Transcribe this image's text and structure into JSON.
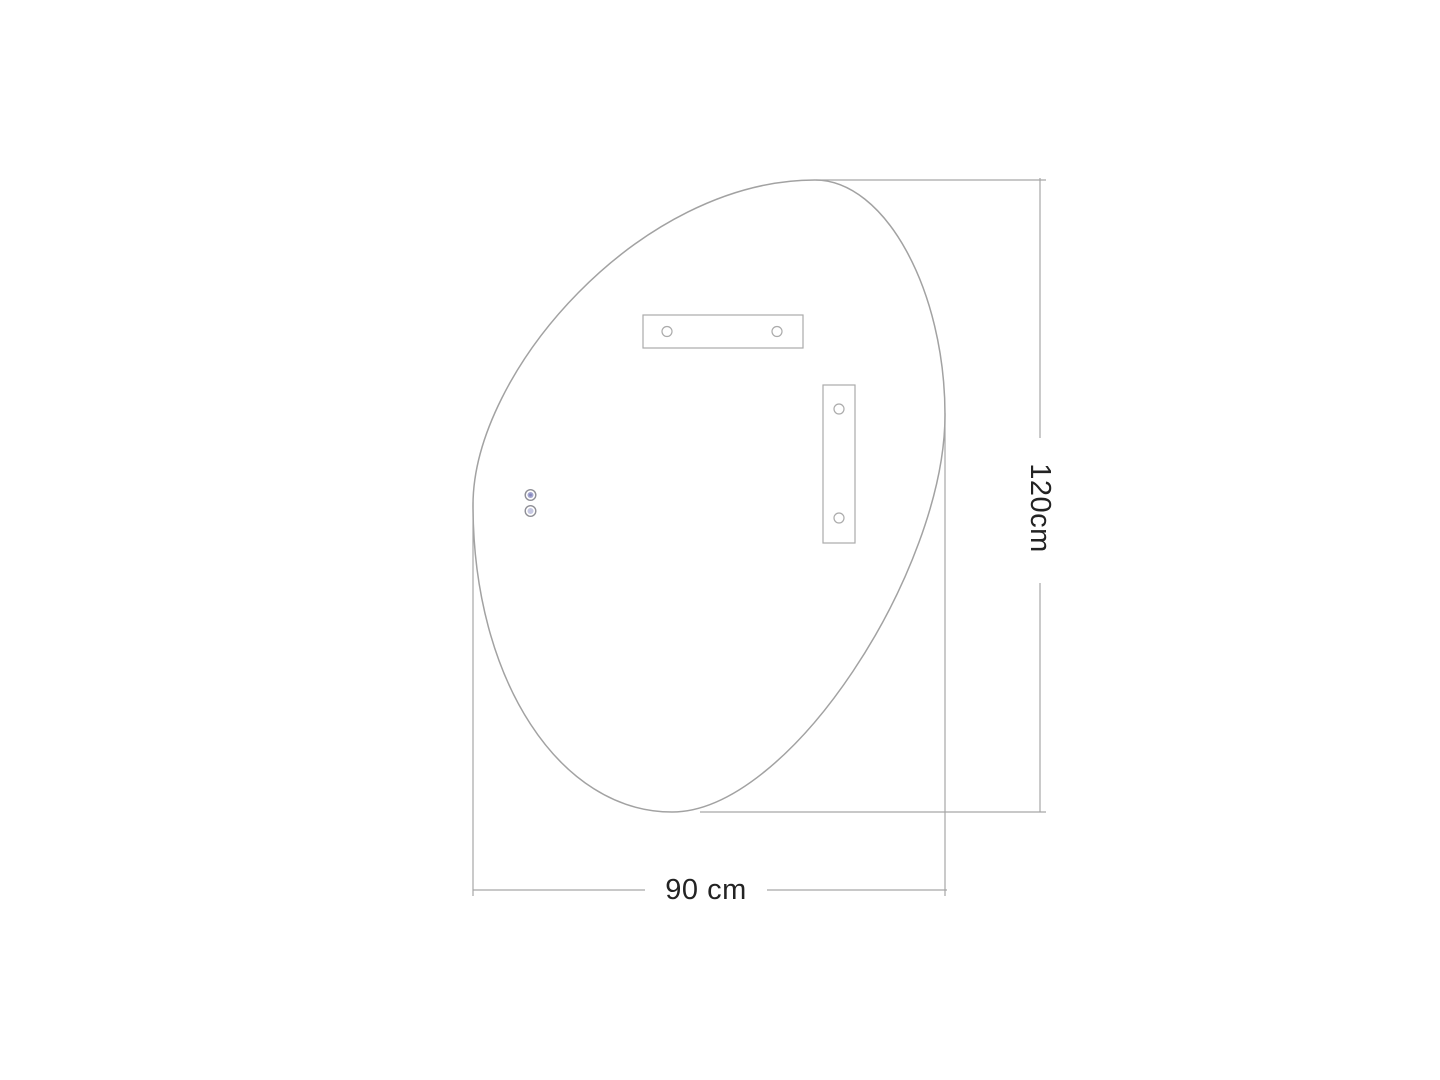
{
  "figure": {
    "height_label": "120cm",
    "width_label": "90 cm"
  },
  "colors": {
    "background": "#ffffff",
    "outline": "#a2a2a2",
    "bracket_line": "#ababab",
    "dimension_line": "#a6a6a6",
    "label_text": "#232323",
    "sensor_ring": "#8f8f96",
    "sensor_top_fill": "#a3a5cf",
    "sensor_top_core": "#8486bd",
    "sensor_bottom_fill": "#c6c8e2"
  }
}
